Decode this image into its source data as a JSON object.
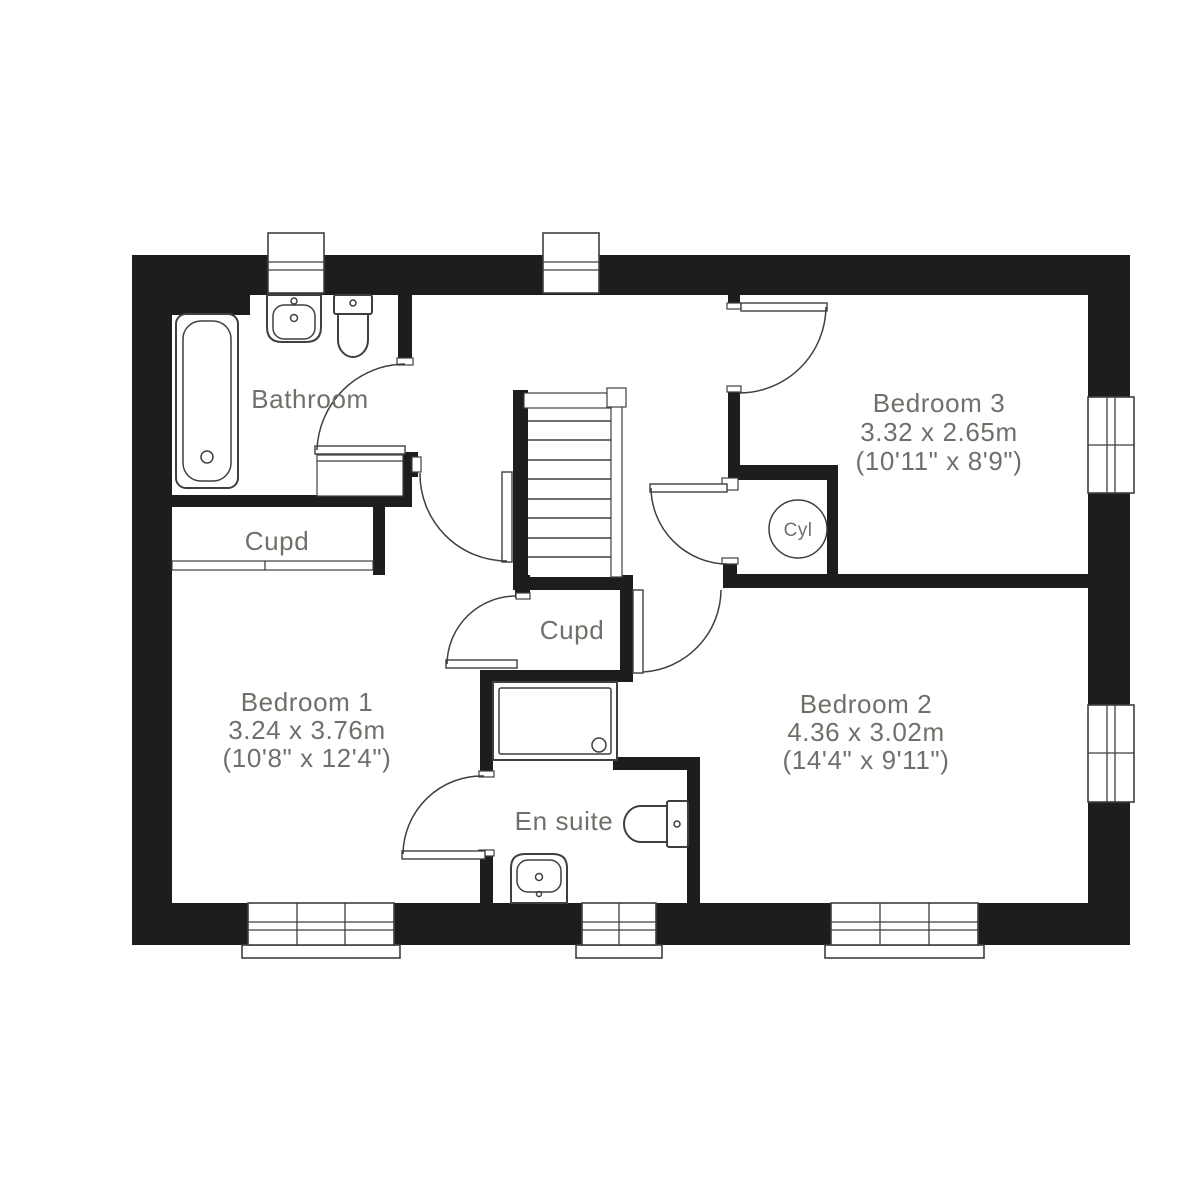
{
  "colors": {
    "wall": "#1d1d1b",
    "line": "#3f3f3d",
    "label": "#70706a",
    "bg": "#ffffff"
  },
  "floorplan": {
    "type": "residential-upper-floor-plan",
    "rooms": [
      {
        "name": "Bathroom"
      },
      {
        "name": "Cupd"
      },
      {
        "name": "Cupd"
      },
      {
        "name": "Cyl"
      },
      {
        "name": "En suite"
      },
      {
        "name": "Bedroom 1",
        "metric": "3.24 x 3.76m",
        "imperial": "(10'8\" x 12'4\")"
      },
      {
        "name": "Bedroom 2",
        "metric": "4.36 x 3.02m",
        "imperial": "(14'4\" x 9'11\")"
      },
      {
        "name": "Bedroom 3",
        "metric": "3.32 x 2.65m",
        "imperial": "(10'11\" x 8'9\")"
      }
    ]
  }
}
